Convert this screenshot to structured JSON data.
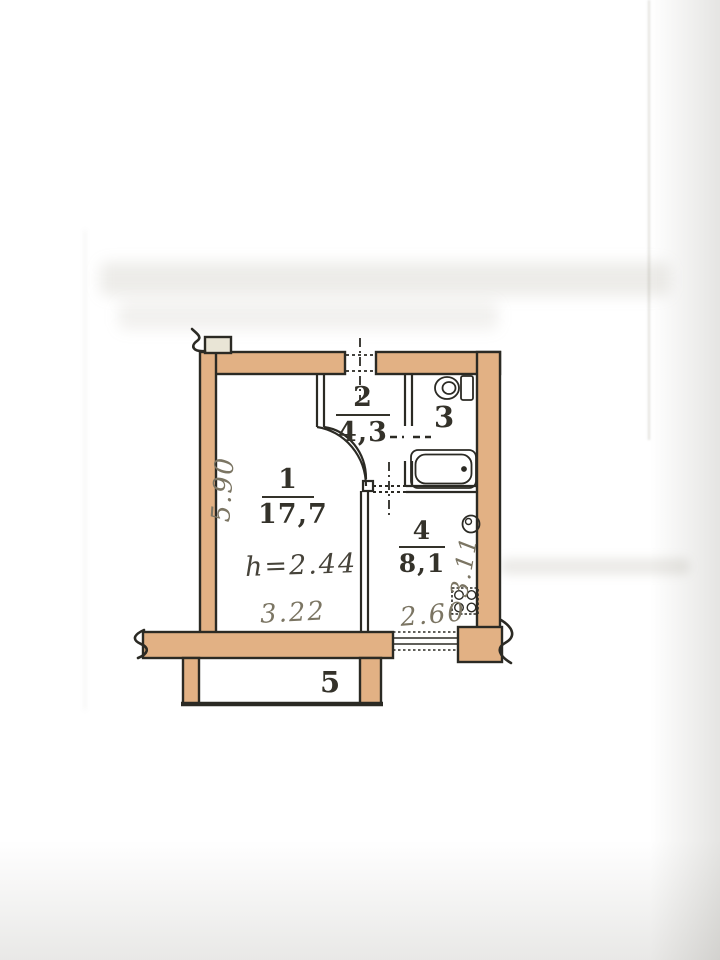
{
  "plan": {
    "room1": {
      "number": "1",
      "area": "17,7"
    },
    "room2": {
      "number": "2",
      "area": "4,3"
    },
    "room3": {
      "number": "3"
    },
    "room4": {
      "number": "4",
      "area": "8,1"
    },
    "room5": {
      "number": "5"
    },
    "ceiling_height": "h=2.44",
    "dimensions": {
      "left_vertical": "5.90",
      "bottom_left": "3.22",
      "bottom_right": "2.60",
      "right_vertical": "3.11"
    },
    "colors": {
      "wall_fill": "#e2b184",
      "line_ink": "#2b2a24",
      "paper": "#e9e5d6",
      "dim_ink": "#7b7563"
    }
  },
  "watermark": {
    "brand": "циан",
    "listing_id": "ID 322557255",
    "icon": "cian-pin-person-icon",
    "color": "#ffffff"
  }
}
